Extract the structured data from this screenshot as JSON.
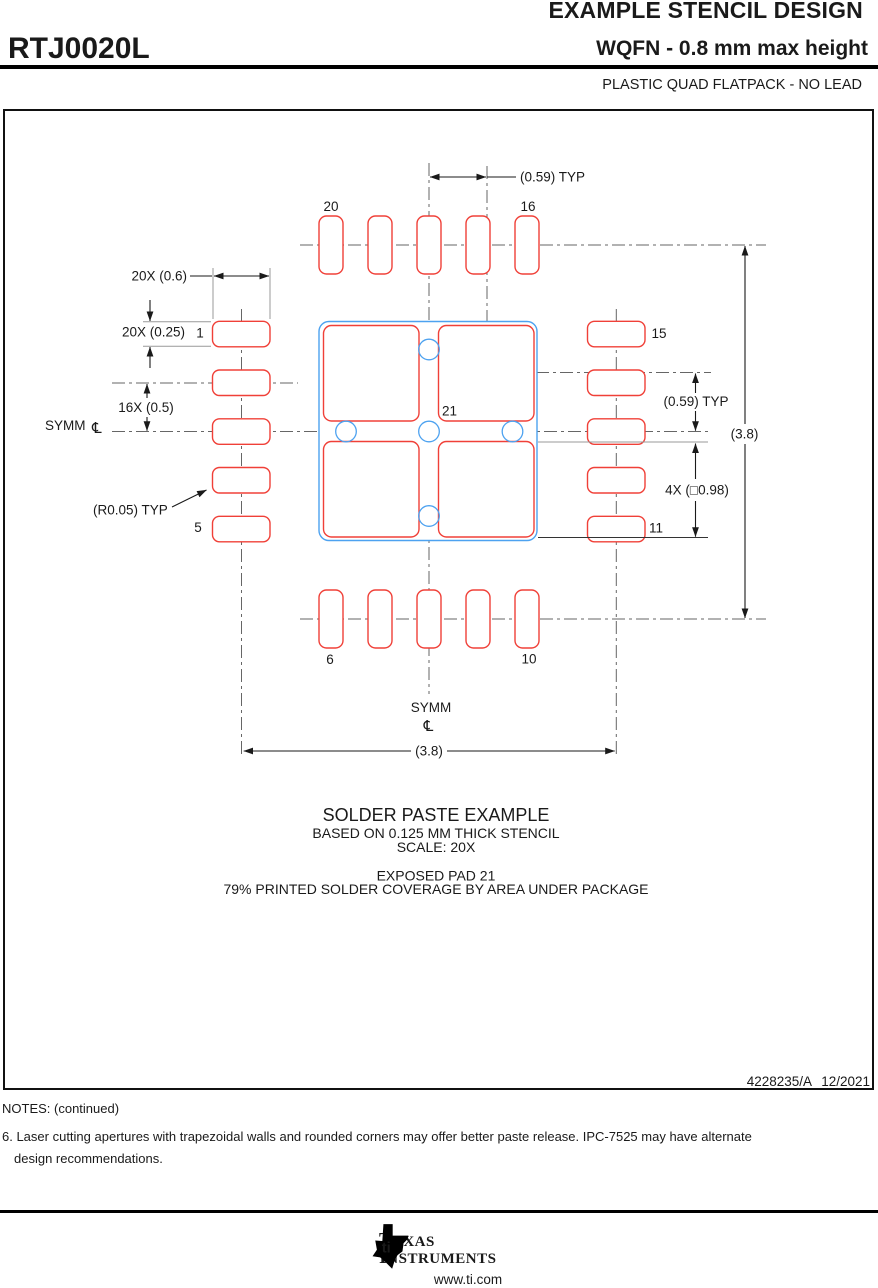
{
  "header": {
    "title": "EXAMPLE STENCIL DESIGN",
    "part_number": "RTJ0020L",
    "subtitle": "WQFN - 0.8 mm max height",
    "package_type": "PLASTIC QUAD FLATPACK - NO LEAD"
  },
  "drawing": {
    "dims": {
      "top_pitch": "(0.59) TYP",
      "pad_width": "20X (0.6)",
      "pad_height": "20X (0.25)",
      "pad_pitch": "16X (0.5)",
      "right_pitch": "(0.59) TYP",
      "paste_square": "4X (□0.98)",
      "overall_width": "(3.8)",
      "overall_height": "(3.8)",
      "corner_radius": "(R0.05) TYP"
    },
    "symm_label": "SYMM",
    "centerline_symbol": "℄",
    "pad_numbers": {
      "p1": "1",
      "p5": "5",
      "p6": "6",
      "p10": "10",
      "p11": "11",
      "p15": "15",
      "p16": "16",
      "p20": "20",
      "p21": "21"
    },
    "caption": {
      "title": "SOLDER PASTE EXAMPLE",
      "line2": "BASED ON 0.125 MM THICK STENCIL",
      "line3": "SCALE: 20X",
      "line4": "EXPOSED PAD 21",
      "line5": "79% PRINTED SOLDER COVERAGE BY AREA UNDER PACKAGE"
    }
  },
  "title_block": {
    "doc_number": "4228235/A",
    "date": "12/2021"
  },
  "notes": {
    "heading": "NOTES: (continued)",
    "note6_line1": "6. Laser cutting apertures with trapezoidal walls and rounded corners may offer better paste release. IPC-7525 may have alternate",
    "note6_line2": "design recommendations."
  },
  "footer": {
    "brand_line1_initial": "T",
    "brand_line1_rest": "EXAS",
    "brand_line2_initial": "I",
    "brand_line2_rest": "NSTRUMENTS",
    "logo_monogram": "ti",
    "url": "www.ti.com"
  },
  "colors": {
    "red": "#f04038",
    "blue": "#4da2f0",
    "cl": "#666666"
  }
}
